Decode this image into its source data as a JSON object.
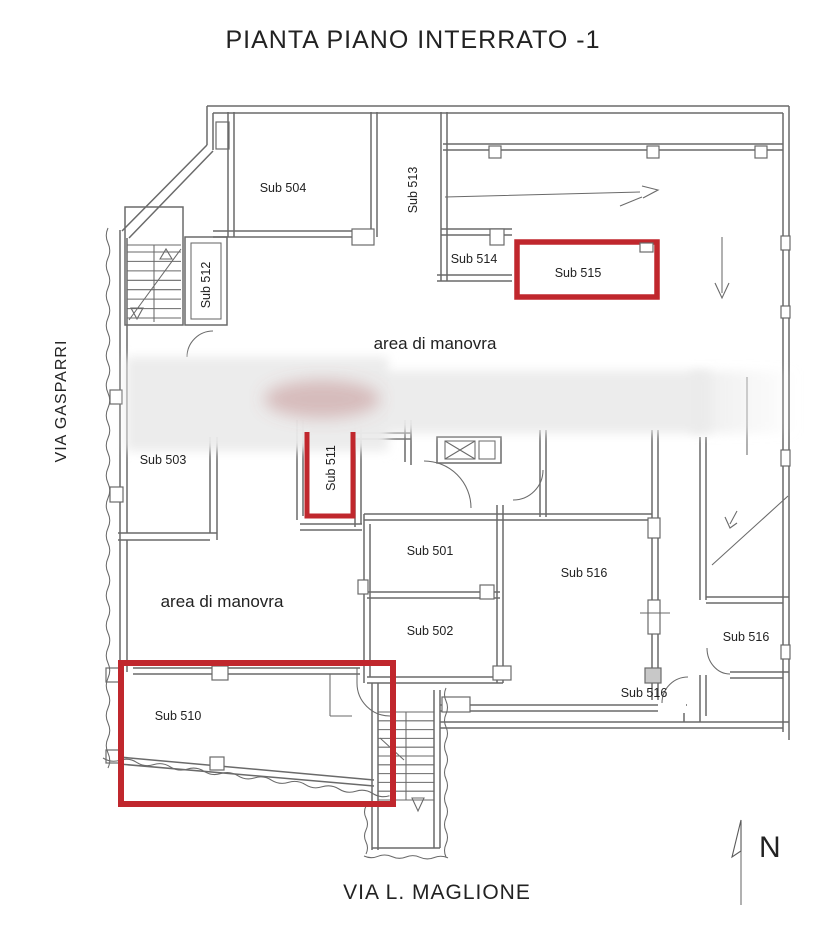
{
  "title": "PIANTA PIANO INTERRATO -1",
  "plan": {
    "streets": {
      "west": "VIA GASPARRI",
      "south": "VIA L. MAGLIONE"
    },
    "compass_label": "N",
    "area_labels": {
      "manovra_upper": "area di manovra",
      "manovra_lower": "area di manovra"
    },
    "room_labels": {
      "sub504": "Sub 504",
      "sub513": "Sub 513",
      "sub514": "Sub 514",
      "sub515": "Sub 515",
      "sub512": "Sub 512",
      "sub503": "Sub 503",
      "sub511": "Sub 511",
      "sub501": "Sub 501",
      "sub502": "Sub 502",
      "sub516_main": "Sub 516",
      "sub516_right": "Sub 516",
      "sub516_lower": "Sub 516",
      "sub510": "Sub 510"
    },
    "highlighted_subs": [
      "Sub 515",
      "Sub 511",
      "Sub 510"
    ],
    "colors": {
      "highlight": "#c0272d",
      "wall": "#6a6a6a",
      "text": "#222222"
    }
  }
}
